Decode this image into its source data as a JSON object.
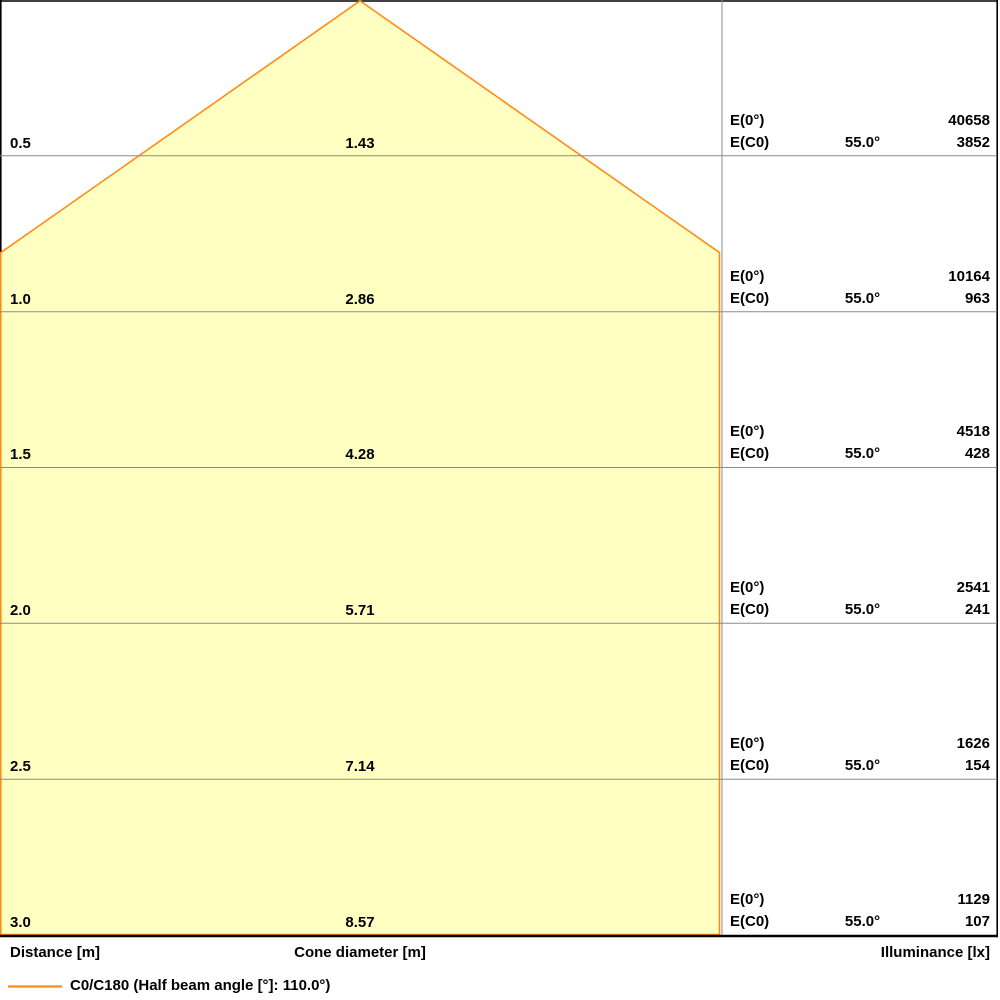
{
  "colors": {
    "cone_fill": "#FFFFC2",
    "cone_edge": "#FF8C1A",
    "grid_line": "#8C8C8C",
    "frame": "#000000"
  },
  "axis": {
    "distance_label": "Distance [m]",
    "cone_diameter_label": "Cone diameter [m]",
    "illuminance_label": "Illuminance [lx]"
  },
  "legend": {
    "label": "C0/C180 (Half beam angle [°]: 110.0°)"
  },
  "rows": [
    {
      "distance": "0.5",
      "diameter": "1.43",
      "e0_label": "E(0°)",
      "ec0_label": "E(C0)",
      "angle": "55.0°",
      "e0": "40658",
      "ec0": "3852"
    },
    {
      "distance": "1.0",
      "diameter": "2.86",
      "e0_label": "E(0°)",
      "ec0_label": "E(C0)",
      "angle": "55.0°",
      "e0": "10164",
      "ec0": "963"
    },
    {
      "distance": "1.5",
      "diameter": "4.28",
      "e0_label": "E(0°)",
      "ec0_label": "E(C0)",
      "angle": "55.0°",
      "e0": "4518",
      "ec0": "428"
    },
    {
      "distance": "2.0",
      "diameter": "5.71",
      "e0_label": "E(0°)",
      "ec0_label": "E(C0)",
      "angle": "55.0°",
      "e0": "2541",
      "ec0": "241"
    },
    {
      "distance": "2.5",
      "diameter": "7.14",
      "e0_label": "E(0°)",
      "ec0_label": "E(C0)",
      "angle": "55.0°",
      "e0": "1626",
      "ec0": "154"
    },
    {
      "distance": "3.0",
      "diameter": "8.57",
      "e0_label": "E(0°)",
      "ec0_label": "E(C0)",
      "angle": "55.0°",
      "e0": "1129",
      "ec0": "107"
    }
  ],
  "chart_data": {
    "type": "area",
    "subtype": "luminaire-light-cone-diagram",
    "title": "",
    "columns": [
      "Distance [m]",
      "Cone diameter [m]",
      "Illuminance [lx]"
    ],
    "legend_entries": [
      "C0/C180 (Half beam angle [°]: 110.0°)"
    ],
    "legend_position": "bottom-left",
    "grid": true,
    "half_beam_angle_deg": 110.0,
    "c_plane_angle_deg": 55.0,
    "distances_m": [
      0.5,
      1.0,
      1.5,
      2.0,
      2.5,
      3.0
    ],
    "cone_diameters_m": [
      1.43,
      2.86,
      4.28,
      5.71,
      7.14,
      8.57
    ],
    "series": [
      {
        "name": "E(0°) [lx]",
        "values": [
          40658,
          10164,
          4518,
          2541,
          1626,
          1129
        ]
      },
      {
        "name": "E(C0) [lx]",
        "values": [
          3852,
          963,
          428,
          241,
          154,
          107
        ]
      }
    ]
  }
}
